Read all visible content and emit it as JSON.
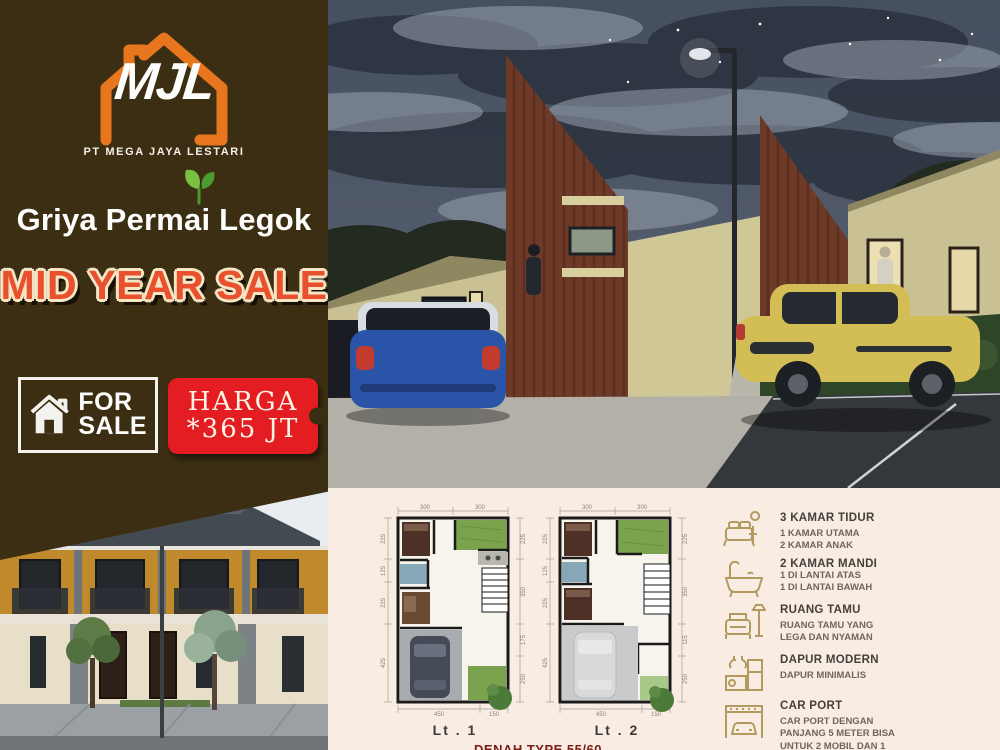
{
  "brand": {
    "logo_monogram": "MJL",
    "company": "PT MEGA JAYA LESTARI",
    "accent_orange": "#e8761f"
  },
  "project": {
    "title": "Griya Permai Legok"
  },
  "promo": {
    "headline": "MID YEAR SALE",
    "color": "#e8502e"
  },
  "for_sale": {
    "line1": "FOR",
    "line2": "SALE"
  },
  "price_tag": {
    "label": "HARGA",
    "value": "*365 JT",
    "color": "#e31d22"
  },
  "colors": {
    "panel_brown": "#3c2e12",
    "plans_cream": "#f9ece3",
    "spec_icon_tan": "#b39b5f"
  },
  "floor_plans": {
    "caption": "DENAH TYPE 55/60",
    "lt1": {
      "label": "Lt . 1",
      "dims": {
        "top": [
          "300",
          "300"
        ],
        "left": [
          "225",
          "125",
          "225",
          "425"
        ],
        "right": [
          "225",
          "350",
          "175",
          "250"
        ],
        "bottom": [
          "450",
          "150"
        ]
      }
    },
    "lt2": {
      "label": "Lt . 2",
      "dims": {
        "top": [
          "300",
          "300"
        ],
        "left": [
          "225",
          "125",
          "225",
          "425"
        ],
        "right": [
          "225",
          "350",
          "115",
          "250"
        ],
        "bottom": [
          "450",
          "150"
        ]
      }
    }
  },
  "specs": {
    "items": [
      {
        "icon": "bed-icon",
        "title": "3 KAMAR TIDUR",
        "lines": [
          "1 KAMAR UTAMA",
          "2 KAMAR ANAK"
        ]
      },
      {
        "icon": "bathtub-icon",
        "title": "2 KAMAR MANDI",
        "lines": [
          "1 DI LANTAI ATAS",
          "1 DI LANTAI BAWAH"
        ]
      },
      {
        "icon": "sofa-icon",
        "title": "RUANG TAMU",
        "lines": [
          "RUANG TAMU YANG",
          "LEGA DAN NYAMAN"
        ]
      },
      {
        "icon": "kitchen-icon",
        "title": "DAPUR MODERN",
        "lines": [
          "DAPUR MINIMALIS"
        ]
      },
      {
        "icon": "carport-icon",
        "title": "CAR PORT",
        "lines": [
          "CAR PORT DENGAN",
          "PANJANG 5 METER BISA",
          "UNTUK 2 MOBIL DAN 1",
          "MOTOR"
        ]
      }
    ]
  }
}
